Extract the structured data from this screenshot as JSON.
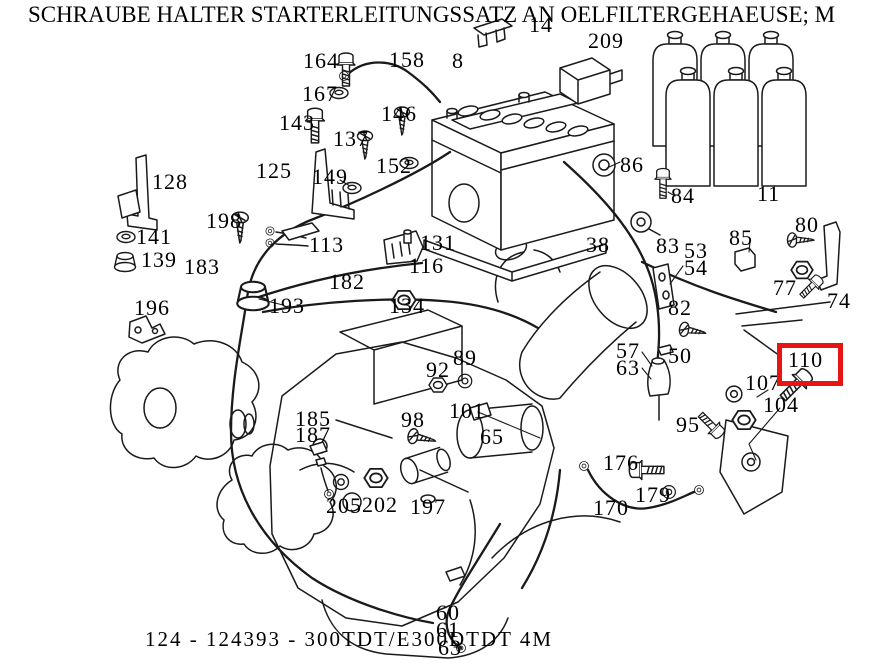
{
  "title": "SCHRAUBE HALTER STARTERLEITUNGSSATZ AN OELFILTERGEHAEUSE; M",
  "footer": {
    "caption": "124 - 124393 - 300TDT/E300DTDT 4M"
  },
  "highlight": {
    "label": "110",
    "color": "#e81313",
    "x": 777,
    "y": 343,
    "width": 56,
    "height": 33
  },
  "line_color": "#1a1a1a",
  "callouts": [
    {
      "label": "164",
      "x": 303,
      "y": 50
    },
    {
      "label": "167",
      "x": 302,
      "y": 83
    },
    {
      "label": "143",
      "x": 279,
      "y": 112
    },
    {
      "label": "137",
      "x": 333,
      "y": 128
    },
    {
      "label": "146",
      "x": 381,
      "y": 103
    },
    {
      "label": "152",
      "x": 376,
      "y": 155
    },
    {
      "label": "125",
      "x": 256,
      "y": 160
    },
    {
      "label": "149",
      "x": 312,
      "y": 166
    },
    {
      "label": "158",
      "x": 389,
      "y": 49
    },
    {
      "label": "8",
      "x": 452,
      "y": 50
    },
    {
      "label": "14",
      "x": 529,
      "y": 14
    },
    {
      "label": "209",
      "x": 588,
      "y": 30
    },
    {
      "label": "128",
      "x": 152,
      "y": 171
    },
    {
      "label": "141",
      "x": 136,
      "y": 226
    },
    {
      "label": "139",
      "x": 141,
      "y": 249
    },
    {
      "label": "198",
      "x": 206,
      "y": 210
    },
    {
      "label": "113",
      "x": 309,
      "y": 234
    },
    {
      "label": "183",
      "x": 184,
      "y": 256
    },
    {
      "label": "182",
      "x": 329,
      "y": 271
    },
    {
      "label": "196",
      "x": 134,
      "y": 297
    },
    {
      "label": "193",
      "x": 269,
      "y": 295
    },
    {
      "label": "131",
      "x": 420,
      "y": 232
    },
    {
      "label": "116",
      "x": 409,
      "y": 255
    },
    {
      "label": "134",
      "x": 389,
      "y": 295
    },
    {
      "label": "86",
      "x": 620,
      "y": 154
    },
    {
      "label": "84",
      "x": 671,
      "y": 185
    },
    {
      "label": "11",
      "x": 757,
      "y": 183
    },
    {
      "label": "38",
      "x": 586,
      "y": 234
    },
    {
      "label": "83",
      "x": 656,
      "y": 235
    },
    {
      "label": "53",
      "x": 684,
      "y": 240
    },
    {
      "label": "54",
      "x": 684,
      "y": 257
    },
    {
      "label": "85",
      "x": 729,
      "y": 227
    },
    {
      "label": "80",
      "x": 795,
      "y": 214
    },
    {
      "label": "77",
      "x": 773,
      "y": 277
    },
    {
      "label": "74",
      "x": 827,
      "y": 290
    },
    {
      "label": "82",
      "x": 668,
      "y": 297
    },
    {
      "label": "57",
      "x": 616,
      "y": 340
    },
    {
      "label": "63",
      "x": 616,
      "y": 357
    },
    {
      "label": "50",
      "x": 668,
      "y": 345
    },
    {
      "label": "110",
      "x": 788,
      "y": 349
    },
    {
      "label": "107",
      "x": 745,
      "y": 372
    },
    {
      "label": "104",
      "x": 763,
      "y": 394
    },
    {
      "label": "95",
      "x": 676,
      "y": 414
    },
    {
      "label": "176",
      "x": 603,
      "y": 452
    },
    {
      "label": "179",
      "x": 635,
      "y": 484
    },
    {
      "label": "170",
      "x": 593,
      "y": 497
    },
    {
      "label": "92",
      "x": 426,
      "y": 359
    },
    {
      "label": "89",
      "x": 453,
      "y": 347
    },
    {
      "label": "98",
      "x": 401,
      "y": 409
    },
    {
      "label": "101",
      "x": 449,
      "y": 400
    },
    {
      "label": "65",
      "x": 480,
      "y": 426
    },
    {
      "label": "185",
      "x": 295,
      "y": 408
    },
    {
      "label": "187",
      "x": 295,
      "y": 424
    },
    {
      "label": "205",
      "x": 326,
      "y": 495
    },
    {
      "label": "202",
      "x": 362,
      "y": 494
    },
    {
      "label": "197",
      "x": 410,
      "y": 496
    },
    {
      "label": "60",
      "x": 436,
      "y": 602
    },
    {
      "label": "61",
      "x": 436,
      "y": 619
    },
    {
      "label": "63",
      "x": 438,
      "y": 637
    }
  ]
}
